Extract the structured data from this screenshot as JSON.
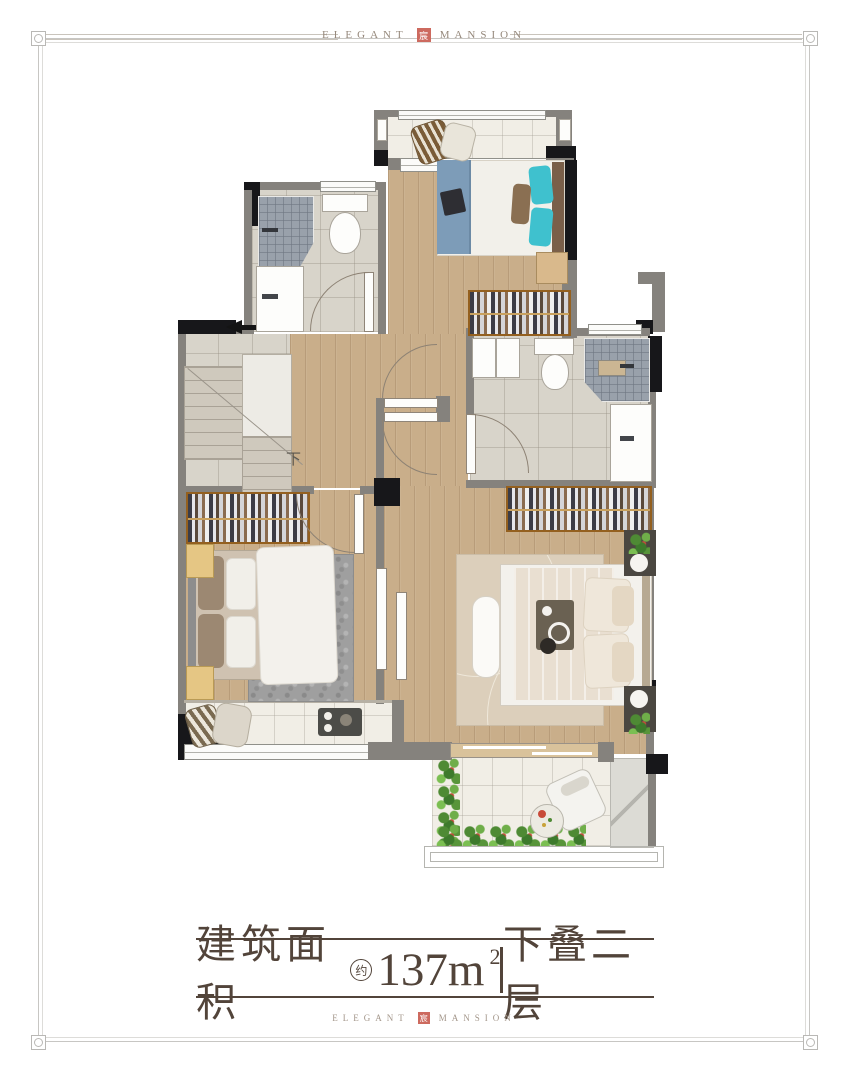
{
  "brand": {
    "left": "ELEGANT",
    "right": "MANSION",
    "seal": "宸"
  },
  "caption": {
    "area_label": "建筑面积",
    "approx": "约",
    "area_number": "137m",
    "area_sup": "2",
    "floor_label": "下叠二层"
  },
  "plan": {
    "stairs_down_label": "下"
  },
  "colors": {
    "caption_brown": "#52443a",
    "brand_gray_brown": "#96897c",
    "seal_red": "#cd6a5f",
    "wall_gray": "#85827d",
    "wall_black": "#17171a",
    "wood_floor": "#c9ae8a",
    "marble_floor": "#d8d4ca",
    "white_tile": "#f1eee6",
    "shower_tile": "#99a1ab",
    "wardrobe_wood": "#b5763b",
    "teal_pillow": "#3fc1ce",
    "blue_blanket": "#7d9cb8",
    "plant_green": "#4e8a34"
  }
}
